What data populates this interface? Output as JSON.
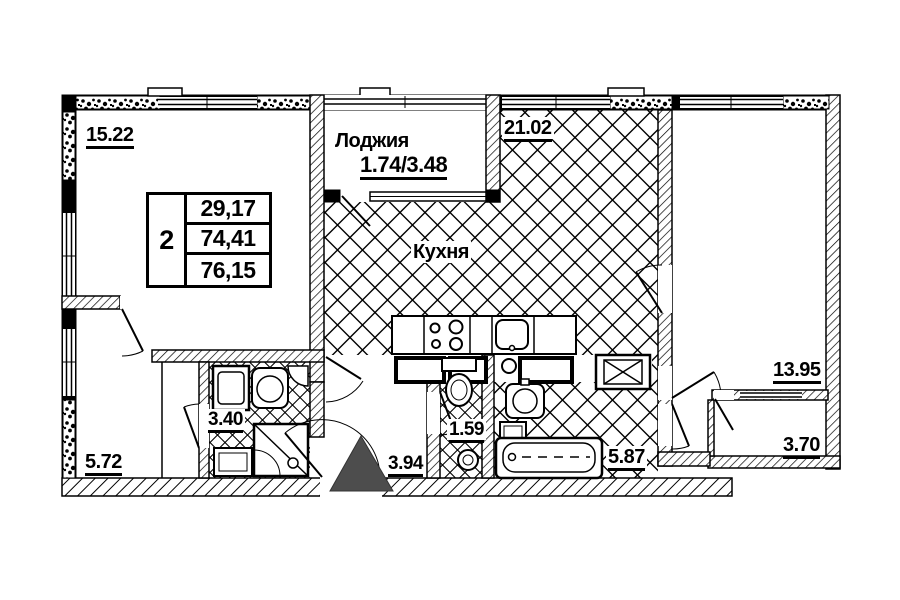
{
  "rooms": {
    "living_room": {
      "area": "15.22"
    },
    "kitchen_living": {
      "area": "21.02"
    },
    "kitchen": {
      "name": "Кухня"
    },
    "loggia": {
      "name": "Лоджия",
      "area": "1.74/3.48"
    },
    "bedroom": {
      "area": "13.95"
    },
    "bedroom_loggia": {
      "area": "3.70"
    },
    "bathroom": {
      "area": "5.87"
    },
    "wc": {
      "area": "1.59"
    },
    "hallway": {
      "area": "3.94"
    },
    "shower_room": {
      "area": "3.40"
    },
    "wardrobe": {
      "area": "5.72"
    }
  },
  "info_table": {
    "rooms_count": "2",
    "living_area": "29,17",
    "apartment_area": "74,41",
    "total_area": "76,15"
  },
  "colors": {
    "line": "#000000",
    "background": "#ffffff",
    "entrance_marker": "#4d4d4d"
  }
}
